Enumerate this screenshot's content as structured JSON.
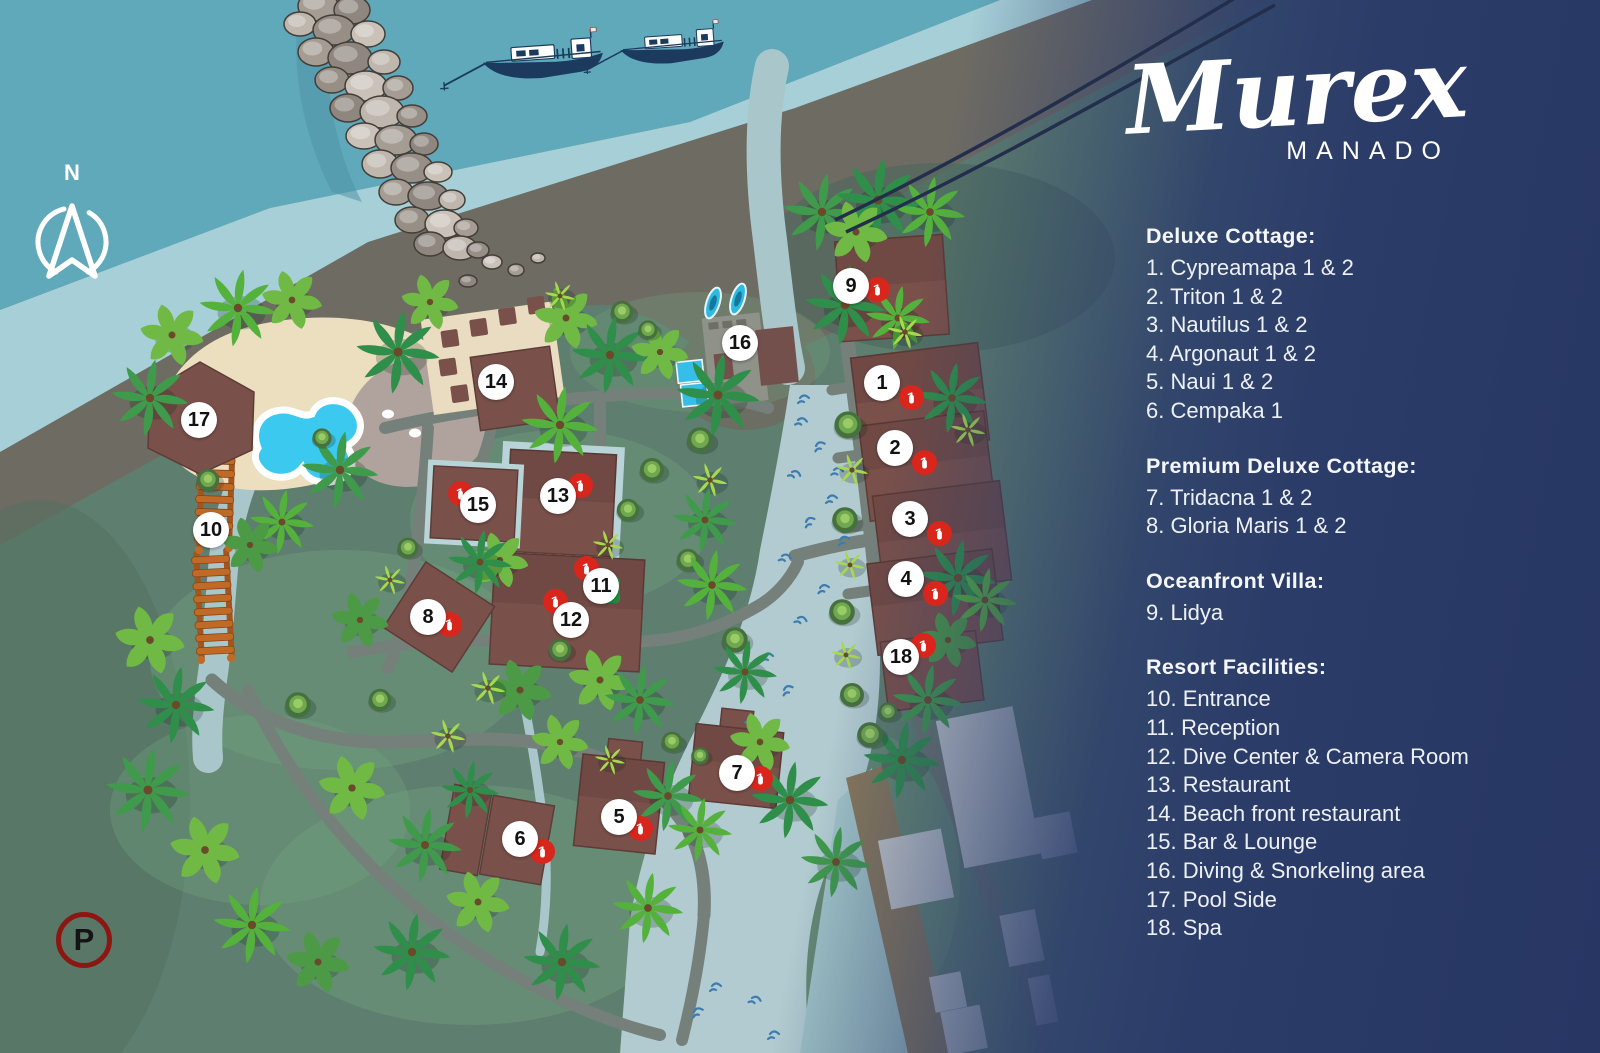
{
  "brand": {
    "name": "Murex",
    "location": "MANADO"
  },
  "compass": {
    "label": "N"
  },
  "parking": {
    "label": "P"
  },
  "map": {
    "markers": [
      "1",
      "2",
      "3",
      "4",
      "5",
      "6",
      "7",
      "8",
      "9",
      "10",
      "11",
      "12",
      "13",
      "14",
      "15",
      "16",
      "17",
      "18"
    ],
    "icons": [
      "fire-extinguisher-icon",
      "first-aid-icon",
      "compass-icon",
      "parking-icon"
    ],
    "colors": {
      "marker_red": "#d8261c",
      "building_brown": "#7a504a",
      "pool_blue": "#3cc9ef",
      "ocean_teal": "#5fa9ba",
      "panel_navy": "#2b3c68",
      "land_green": "#5e7e6f"
    }
  },
  "legend": {
    "sections": [
      {
        "title": "Deluxe Cottage:",
        "items": [
          "1. Cypreamapa 1 & 2",
          "2. Triton 1 & 2",
          "3. Nautilus 1 & 2",
          "4. Argonaut 1 & 2",
          "5. Naui 1 & 2",
          "6. Cempaka 1"
        ]
      },
      {
        "title": "Premium Deluxe Cottage:",
        "items": [
          "7.  Tridacna 1 & 2",
          "8.  Gloria Maris 1 & 2"
        ]
      },
      {
        "title": "Oceanfront Villa:",
        "items": [
          "9.  Lidya"
        ]
      },
      {
        "title": "Resort Facilities:",
        "items": [
          "10. Entrance",
          "11. Reception",
          "12. Dive Center & Camera Room",
          "13. Restaurant",
          "14. Beach front restaurant",
          "15. Bar & Lounge",
          "16. Diving & Snorkeling area",
          "17. Pool Side",
          "18. Spa"
        ]
      }
    ]
  }
}
